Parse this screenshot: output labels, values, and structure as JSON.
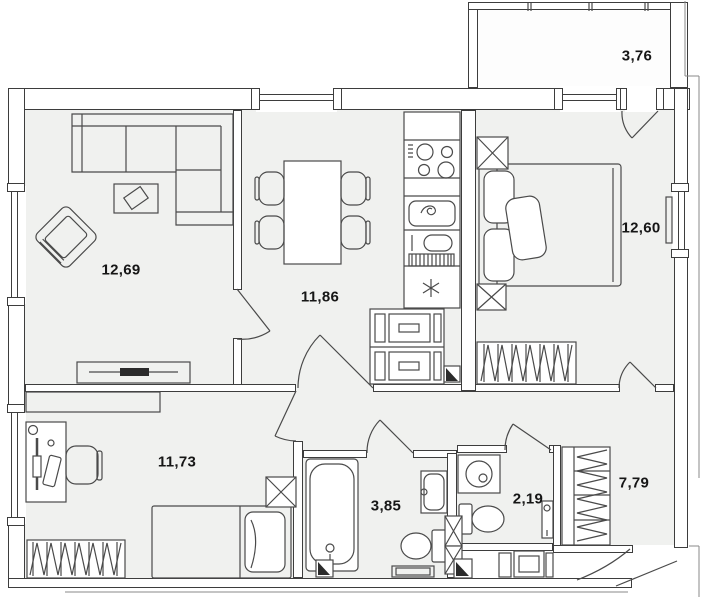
{
  "plan": {
    "type": "apartment-floor-plan",
    "rooms": {
      "living_room": {
        "area": "12,69"
      },
      "kitchen_dining": {
        "area": "11,86"
      },
      "bedroom": {
        "area": "12,60"
      },
      "balcony": {
        "area": "3,76"
      },
      "second_room": {
        "area": "11,73"
      },
      "bathroom": {
        "area": "3,85"
      },
      "wc": {
        "area": "2,19"
      },
      "hallway": {
        "area": "7,79"
      }
    },
    "colors": {
      "wall_line": "#3d3d3d",
      "room_fill": "#f0f1ef",
      "furniture_line": "#4a4a4a",
      "background": "#ffffff"
    }
  }
}
